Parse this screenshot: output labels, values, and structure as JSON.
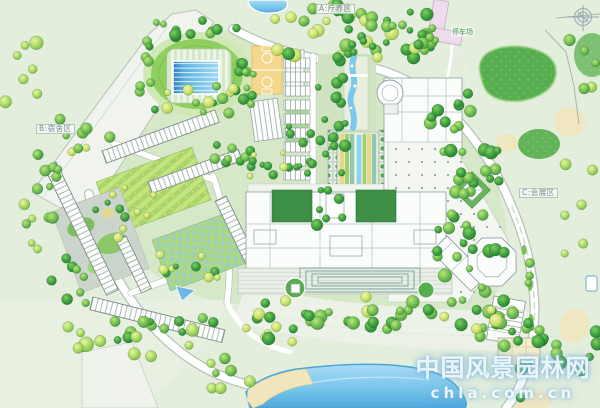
{
  "plan": {
    "title": "resort campus landscape master plan",
    "labels": {
      "zone_top": "A:疗养区",
      "zone_left": "B:宿舍区",
      "zone_right": "C:会展区",
      "parking": "停车场"
    },
    "watermark": {
      "site_name": "中国风景园林网",
      "site_url": "chla.com.cn"
    },
    "palette": {
      "paper": "#dfead7",
      "paper_outer": "#e6efdf",
      "lawn": "#d3e6c2",
      "lawn_dark": "#5cb254",
      "tree_dark": "#2f8f3c",
      "tree_mid": "#56b04a",
      "tree_light": "#8fd05c",
      "tree_lime": "#c9e468",
      "water": "#7ecbee",
      "water_deep": "#2e7fbe",
      "road": "#ffffff",
      "road_edge": "#a9b9ad",
      "building": "#fbfdfb",
      "building_line": "#8c9aa4",
      "plaza": "#f3f6f1",
      "court": "#f4d88e",
      "sand": "#f0e6c0",
      "pink_building": "#eedcec",
      "garden_teal": "#9ed1b4",
      "garden_stripe": "#c4e47c"
    }
  }
}
